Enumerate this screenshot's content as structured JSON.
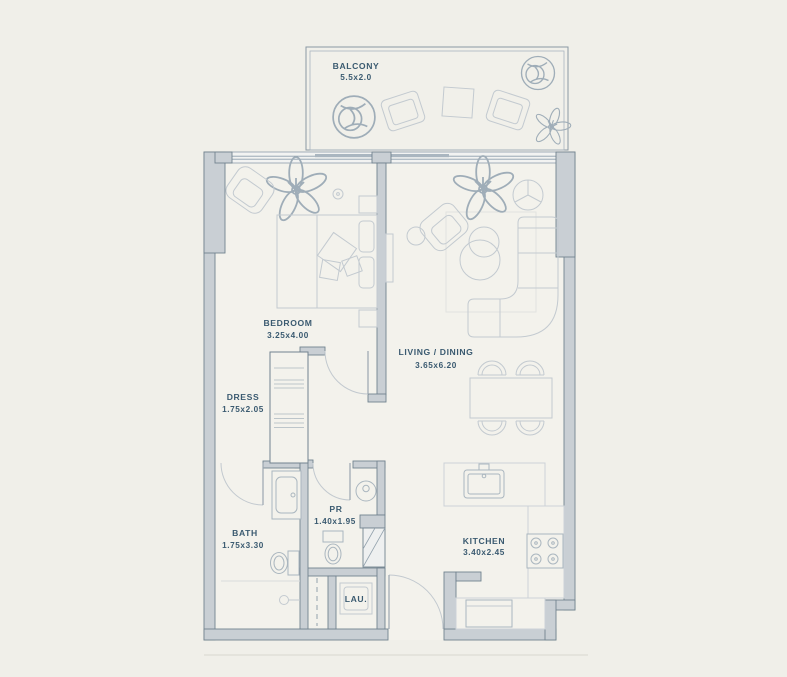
{
  "plan": {
    "type": "apartment-floor-plan",
    "colors": {
      "background": "#f0efe9",
      "floor": "#f3f2ec",
      "wall_fill": "#c9cfd4",
      "wall_stroke": "#72838f",
      "furniture_stroke": "#c3cad0",
      "label_text": "#3a5a70"
    },
    "rooms": {
      "balcony": {
        "label": "BALCONY",
        "dims": "5.5x2.0"
      },
      "bedroom": {
        "label": "BEDROOM",
        "dims": "3.25x4.00"
      },
      "living_dining": {
        "label": "LIVING / DINING",
        "dims": "3.65x6.20"
      },
      "dress": {
        "label": "DRESS",
        "dims": "1.75x2.05"
      },
      "bath": {
        "label": "BATH",
        "dims": "1.75x3.30"
      },
      "pr": {
        "label": "PR",
        "dims": "1.40x1.95"
      },
      "laundry": {
        "label": "LAU."
      },
      "kitchen": {
        "label": "KITCHEN",
        "dims": "3.40x2.45"
      }
    }
  }
}
